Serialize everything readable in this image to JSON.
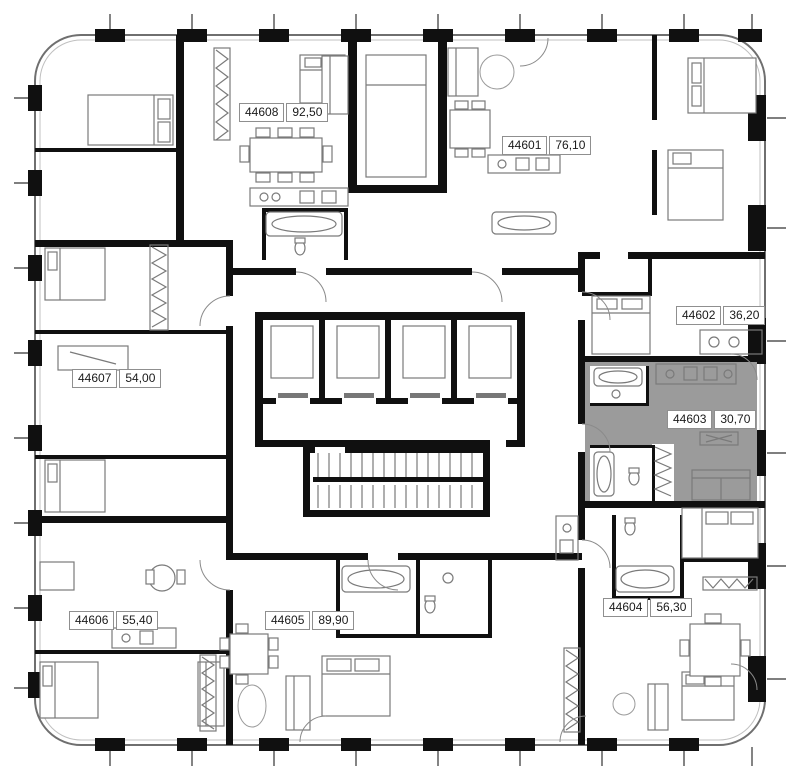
{
  "plan": {
    "title": "residential-floor-plan",
    "units": [
      {
        "id": "44601",
        "area": "76,10",
        "highlighted": false
      },
      {
        "id": "44602",
        "area": "36,20",
        "highlighted": false
      },
      {
        "id": "44603",
        "area": "30,70",
        "highlighted": true
      },
      {
        "id": "44604",
        "area": "56,30",
        "highlighted": false
      },
      {
        "id": "44605",
        "area": "89,90",
        "highlighted": false
      },
      {
        "id": "44606",
        "area": "55,40",
        "highlighted": false
      },
      {
        "id": "44607",
        "area": "54,00",
        "highlighted": false
      },
      {
        "id": "44608",
        "area": "92,50",
        "highlighted": false
      }
    ],
    "colors": {
      "wall": "#101010",
      "highlight": "#9b9b9b",
      "furniture": "#7a7a7a"
    }
  }
}
